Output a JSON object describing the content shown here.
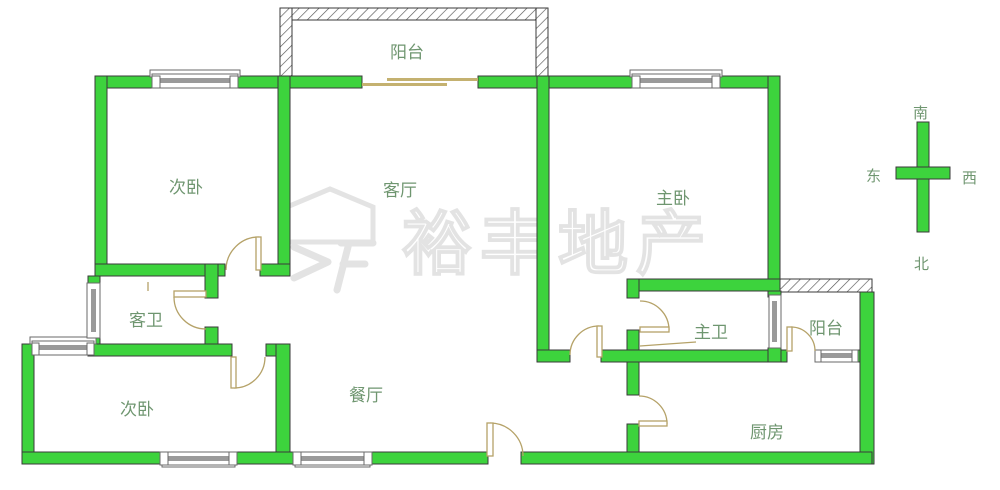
{
  "watermark": {
    "text": "裕丰地产"
  },
  "compass": {
    "south": "南",
    "east": "东",
    "west": "西",
    "north": "北"
  },
  "rooms": {
    "balcony_top": "阳台",
    "bedroom_top_left": "次卧",
    "living_room": "客厅",
    "master_bedroom": "主卧",
    "guest_bathroom": "客卫",
    "master_bathroom": "主卫",
    "balcony_right": "阳台",
    "bedroom_bottom_left": "次卧",
    "dining_room": "餐厅",
    "kitchen": "厨房"
  },
  "colors": {
    "wall_fill": "#3dd33d",
    "wall_outline": "#3a3a3a",
    "door": "#b5a268",
    "window_frame": "#6a6a6a",
    "window_glass": "#9a9a9a",
    "label": "#6f9670",
    "watermark": "#e3e3e3"
  }
}
